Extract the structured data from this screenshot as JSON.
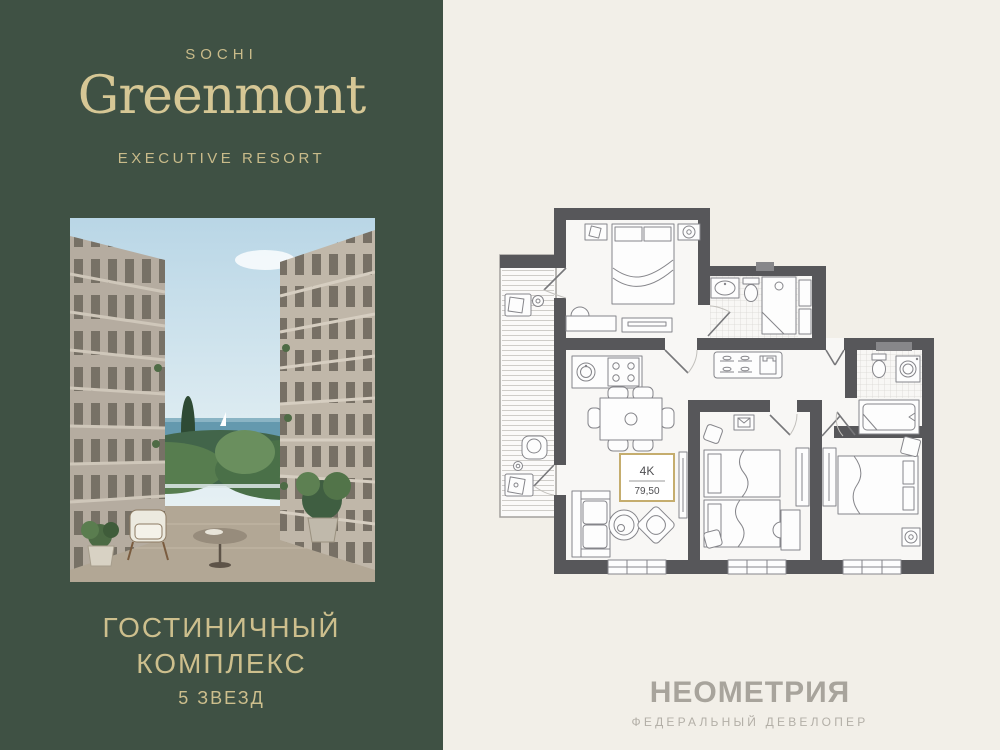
{
  "left_panel": {
    "bg_color": "#3f5144",
    "accent_color": "#d6c795",
    "city": "SOCHI",
    "brand": "Greenmont",
    "tagline": "EXECUTIVE RESORT",
    "complex_type_line1": "ГОСТИНИЧНЫЙ",
    "complex_type_line2": "КОМПЛЕКС",
    "stars": "5 ЗВЕЗД"
  },
  "right_panel": {
    "bg_color": "#f2efe8",
    "floorplan": {
      "unit_type": "4K",
      "area": "79,50",
      "wall_color": "#57575a",
      "label_border_color": "#c5ad6e"
    },
    "developer": {
      "name": "НЕОМЕТРИЯ",
      "subtitle": "ФЕДЕРАЛЬНЫЙ ДЕВЕЛОПЕР"
    }
  }
}
